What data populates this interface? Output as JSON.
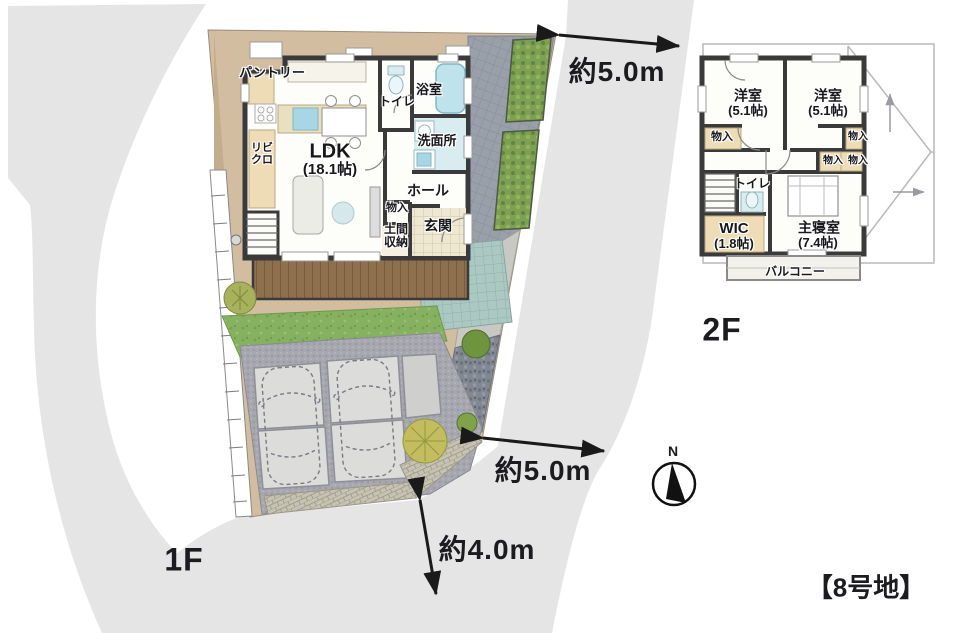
{
  "page": {
    "floor1_label": "1F",
    "floor2_label": "2F",
    "lot_title": "【8号地】"
  },
  "compass": {
    "north_label": "N"
  },
  "dimensions": {
    "top": "約5.0m",
    "side": "約5.0m",
    "bottom": "約4.0m"
  },
  "floor1": {
    "pantry": "パントリー",
    "ldk_name": "LDK",
    "ldk_size": "(18.1帖)",
    "living_closet_line1": "リビ",
    "living_closet_line2": "クロ",
    "toilet": "トイレ",
    "bath": "浴室",
    "washroom": "洗面所",
    "hall": "ホール",
    "storage": "物入",
    "doma_line1": "土間",
    "doma_line2": "収納",
    "entrance": "玄関"
  },
  "floor2": {
    "bedroom1_name": "洋室",
    "bedroom1_size": "(5.1帖)",
    "bedroom2_name": "洋室",
    "bedroom2_size": "(5.1帖)",
    "storage_left": "物入",
    "storage_right": "物入",
    "storage_mid_left": "物入",
    "storage_mid_right": "物入",
    "toilet": "トイレ",
    "wic_name": "WIC",
    "wic_size": "(1.8帖)",
    "master_name": "主寝室",
    "master_size": "(7.4帖)",
    "balcony": "バルコニー"
  },
  "colors": {
    "surround": "#e6e5e6",
    "ground": "#d3bda0",
    "wall": "#3a3a3a",
    "lawn": "#85b161",
    "deck": "#8f6f4e",
    "wet_floor": "#d9ecef",
    "closet_floor": "#eedcb6",
    "text": "#17171c"
  }
}
